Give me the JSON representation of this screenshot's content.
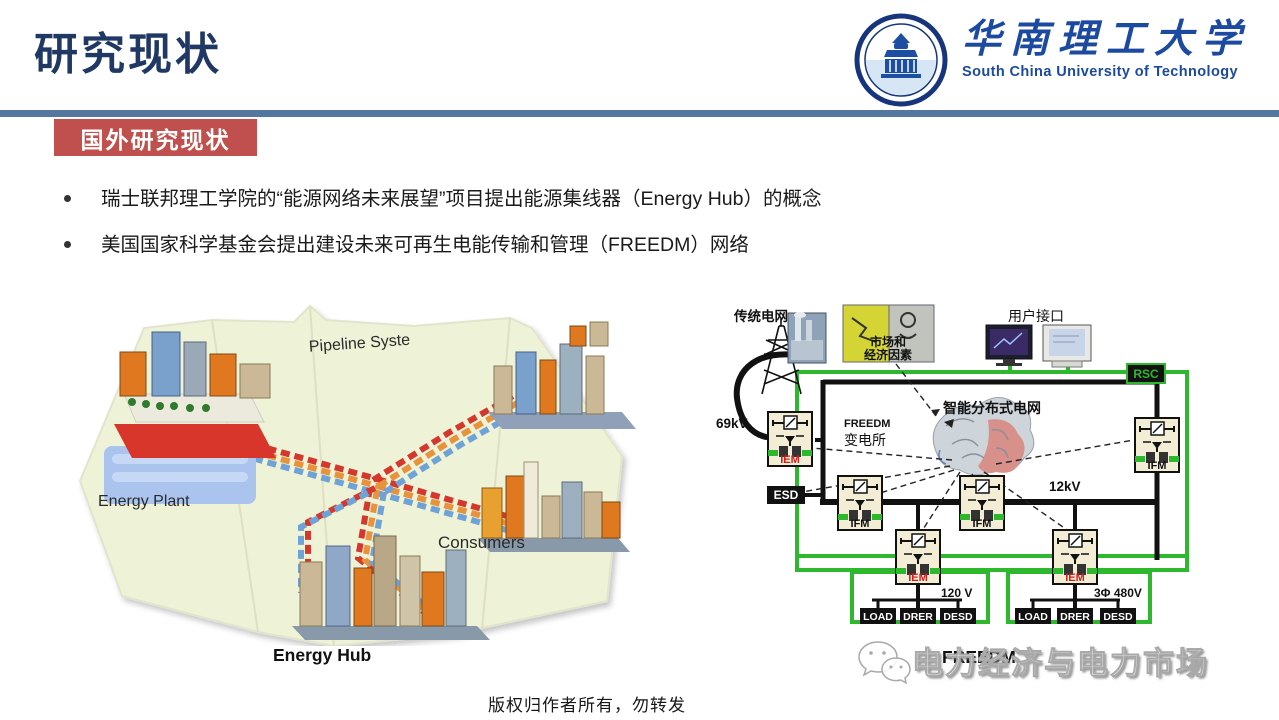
{
  "page": {
    "title": "研究现状",
    "section_badge": "国外研究现状",
    "bullets": [
      "瑞士联邦理工学院的“能源网络未来展望”项目提出能源集线器（Energy Hub）的概念",
      "美国国家科学基金会提出建设未来可再生电能传输和管理（FREEDM）网络"
    ],
    "copyright_note": "版权归作者所有，勿转发"
  },
  "logo": {
    "name_cn": "华南理工大学",
    "name_en": "South China University of Technology"
  },
  "figures": {
    "energy_hub": {
      "caption": "Energy Hub",
      "label_pipeline": "Pipeline Syste",
      "label_plant": "Energy Plant",
      "label_consumers": "Consumers"
    },
    "freedm": {
      "caption": "FREEDM",
      "label_traditional_grid": "传统电网",
      "label_69kv": "69kV",
      "label_market_1": "市场和",
      "label_market_2": "经济因素",
      "label_user_interface": "用户接口",
      "label_rsc": "RSC",
      "label_substation_1": "FREEDM",
      "label_substation_2": "变电所",
      "label_smart_grid": "智能分布式电网",
      "label_12kv": "12kV",
      "label_esd": "ESD",
      "label_ifm": "IFM",
      "label_iem": "IEM",
      "label_120v": "120 V",
      "label_480v": "3Φ 480V",
      "label_load": "LOAD",
      "label_drer": "DRER",
      "label_desd": "DESD"
    }
  },
  "watermark": {
    "text": "电力经济与电力市场"
  },
  "colors": {
    "title_navy": "#1F3864",
    "divider_blue": "#54779F",
    "badge_red": "#C0504D",
    "logo_blue": "#1B4AA0",
    "freedm_green": "#2DB82D",
    "iem_red": "#CC2020",
    "map_bg": "#EEF2D6",
    "pipe_red": "#D4372C",
    "pipe_orange": "#E8923C",
    "pipe_blue": "#6FA3D8"
  }
}
